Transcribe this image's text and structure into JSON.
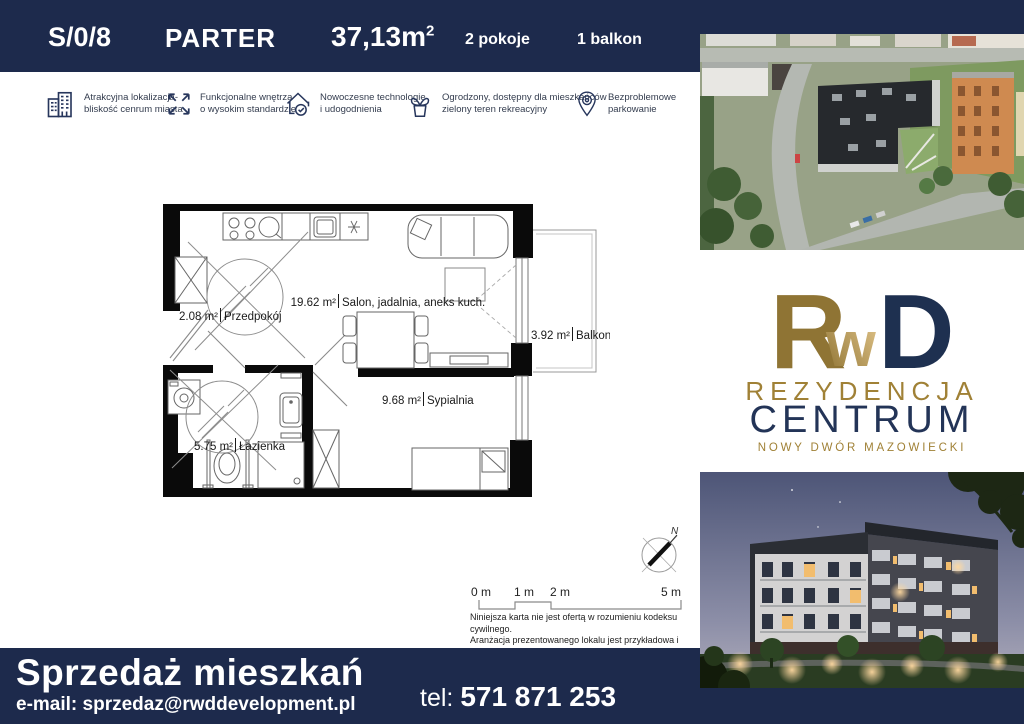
{
  "colors": {
    "navy": "#1d2a4c",
    "gold": "#9b7d35",
    "logo_navy": "#1e3050",
    "plan_wall": "#0a0a0a"
  },
  "header": {
    "unit_number": "S/0/8",
    "floor": "PARTER",
    "area_value": "37,13m",
    "area_superscript": "2",
    "rooms_count": "2 pokoje",
    "balcony_count": "1 balkon"
  },
  "features": [
    {
      "icon": "buildings-icon",
      "line1": "Atrakcyjna lokalizacja-",
      "line2": "bliskość cenrum miasta"
    },
    {
      "icon": "expand-arrows-icon",
      "line1": "Funkcjonalne wnętrza",
      "line2": "o wysokim standardzie"
    },
    {
      "icon": "house-tech-icon",
      "line1": "Nowoczesne technologie",
      "line2": "i udogodnienia"
    },
    {
      "icon": "plant-icon",
      "line1": "Ogrodzony, dostępny dla mieszkańców",
      "line2": "zielony teren rekreacyjny"
    },
    {
      "icon": "parking-pin-icon",
      "line1": "Bezproblemowe",
      "line2": "parkowanie"
    }
  ],
  "floorplan": {
    "rooms": [
      {
        "area": "2.08 m²",
        "name": "Przedpokój"
      },
      {
        "area": "19.62 m²",
        "name": "Salon, jadalnia, aneks kuch."
      },
      {
        "area": "3.92 m²",
        "name": "Balkon"
      },
      {
        "area": "9.68 m²",
        "name": "Sypialnia"
      },
      {
        "area": "5.75 m²",
        "name": "Łazienka"
      }
    ]
  },
  "scale_bar": {
    "label0": "0 m",
    "label1": "1 m",
    "label2": "2 m",
    "label5": "5 m"
  },
  "compass": {
    "north_label": "N"
  },
  "disclaimer": {
    "line1": "Niniejsza karta nie jest ofertą w rozumieniu kodeksu cywilnego.",
    "line2": "Aranżacja prezentowanego lokalu jest przykładowa i może ulec",
    "line3": "zmianie. Podziałka podana z tolerancją 5%."
  },
  "brand": {
    "logo_r": "R",
    "logo_w": "w",
    "logo_d": "D",
    "title_top": "REZYDENCJA",
    "title_main": "CENTRUM",
    "subtitle": "NOWY DWÓR MAZOWIECKI"
  },
  "footer": {
    "headline": "Sprzedaż mieszkań",
    "email": "e-mail: sprzedaz@rwddevelopment.pl",
    "phone_label": "tel:",
    "phone_number": "571 871 253"
  }
}
